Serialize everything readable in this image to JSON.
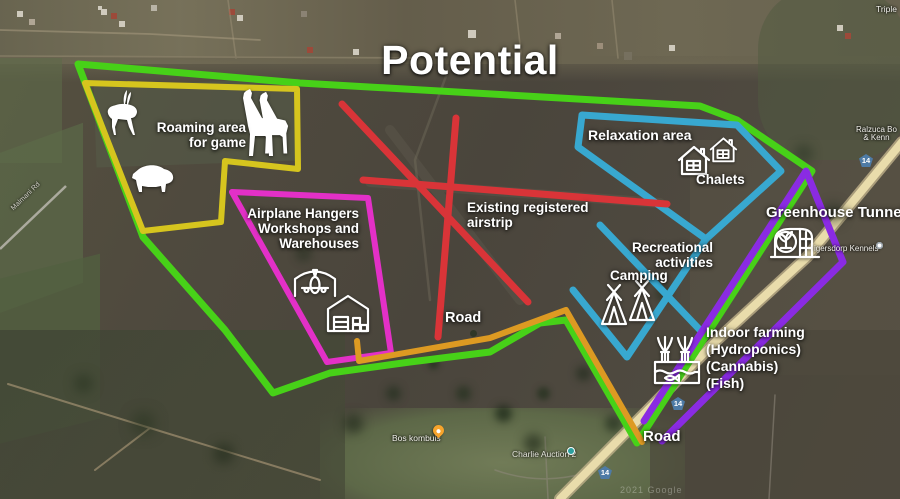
{
  "title": "Potential",
  "annotations": {
    "roaming": {
      "line1": "Roaming area",
      "line2": "for game"
    },
    "hangars": {
      "line1": "Airplane Hangers",
      "line2": "Workshops and",
      "line3": "Warehouses"
    },
    "airstrip": {
      "line1": "Existing registered",
      "line2": "airstrip"
    },
    "road_center": "Road",
    "relaxation": "Relaxation area",
    "chalets": "Chalets",
    "recreation": {
      "line1": "Recreational",
      "line2": "activities",
      "line3": "Camping"
    },
    "greenhouse": "Greenhouse Tunnels",
    "indoor": {
      "line1": "Indoor farming",
      "line2": "(Hydroponics)",
      "line3": "(Cannabis)",
      "line4": "(Fish)"
    },
    "road_bottom": "Road"
  },
  "map_labels": {
    "triple": "Triple",
    "ralzuca_line1": "Ralzuca Bo",
    "ralzuca_line2": "& Kenn",
    "kennels": "igersdorp Kennels",
    "bos_kombuis": "Bos kombuis",
    "charlie_auction": "Charlie Auction 2",
    "malmani": "Malmani Rd",
    "route_shield": "14",
    "watermark": "2021 Google"
  },
  "colors": {
    "boundary": "#47d118",
    "roaming_zone": "#d6c51e",
    "hangars_zone": "#e330c7",
    "airstrip_lines": "#d93438",
    "relaxation_zone": "#38a8d0",
    "farm_road": "#dd9a22",
    "greenhouse_zone": "#8a2be2",
    "highway": "#e9dcab"
  },
  "icons": {
    "antelope-icon": "white antelope silhouette",
    "giraffe-icon": "two white giraffe silhouettes",
    "boar-icon": "white warthog silhouette",
    "hangar-plane-icon": "airplane under hangar arch outline",
    "warehouse-icon": "warehouse with door and crates outline",
    "chalet-icon": "house with window outline (x2)",
    "tent-icon": "tipi tent outline (x2)",
    "greenhouse-icon": "greenhouse tunnel with plant outline",
    "hydroponics-icon": "plants growing from fish tank outline",
    "restaurant-pin": "orange food place pin",
    "auction-pin": "teal place pin",
    "kennels-pin": "white place dot"
  }
}
